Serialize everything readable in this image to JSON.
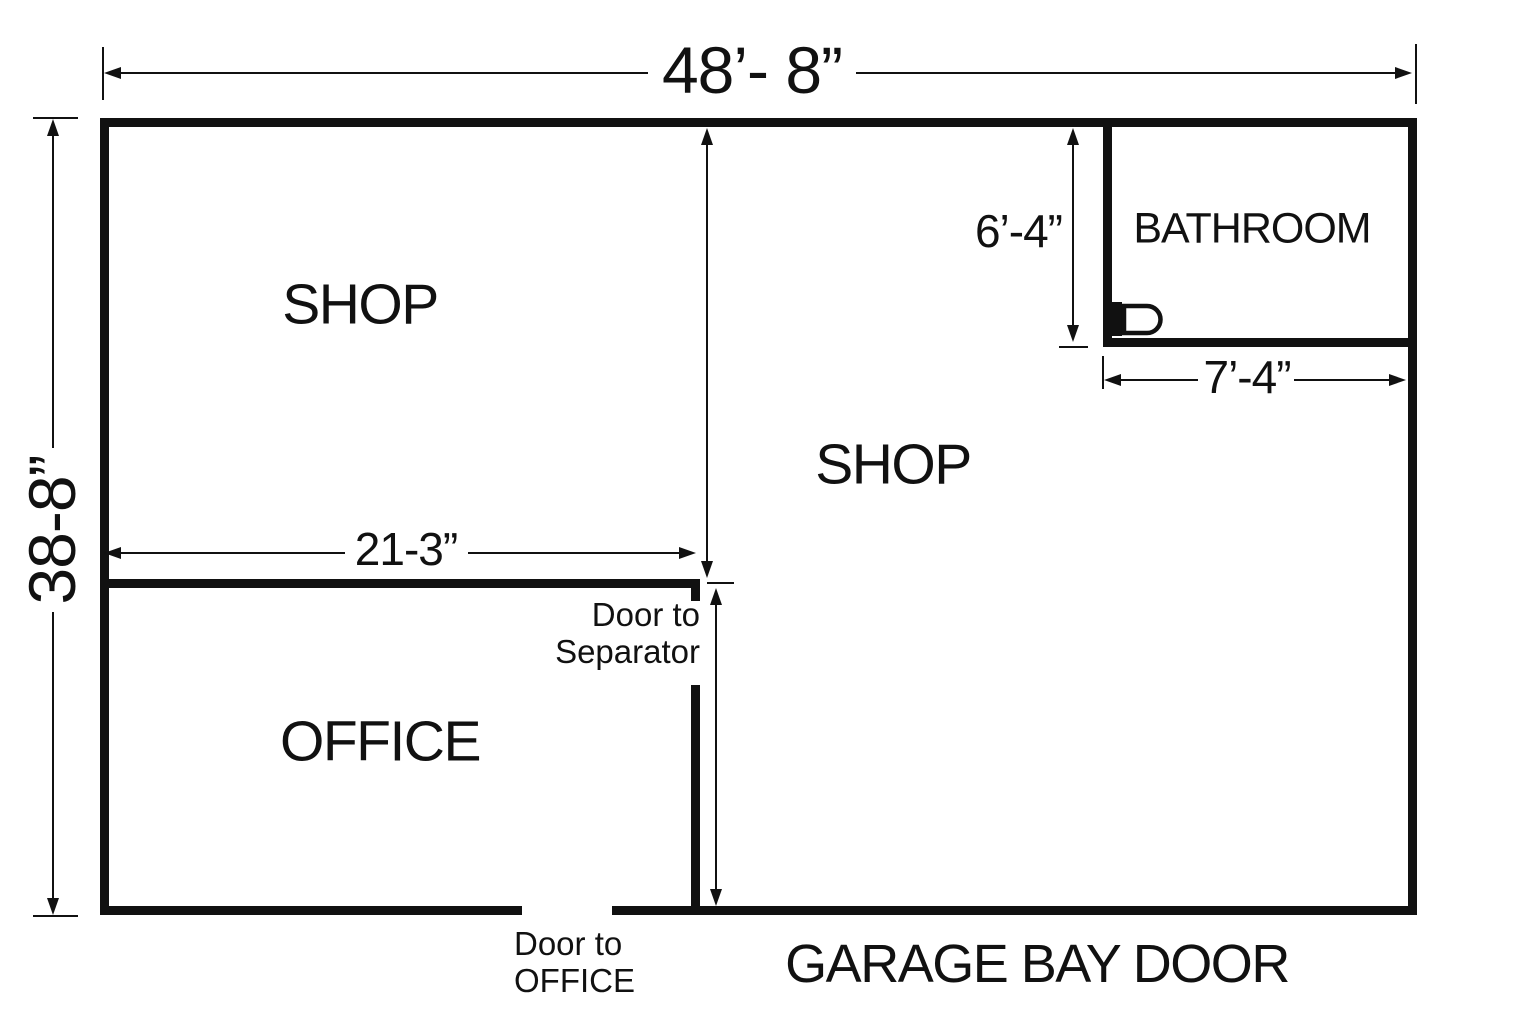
{
  "colors": {
    "ink": "#111111",
    "bg": "#ffffff"
  },
  "dimensions": {
    "overall_width": "48’- 8”",
    "overall_height": "38-8”",
    "partition_width": "21-3”",
    "bathroom_height": "6’-4”",
    "bathroom_width": "7’-4”"
  },
  "rooms": {
    "shop_upper_left": "SHOP",
    "shop_main": "SHOP",
    "office": "OFFICE",
    "bathroom": "BATHROOM"
  },
  "labels": {
    "door_to_separator": {
      "line1": "Door to",
      "line2": "Separator"
    },
    "door_to_office": {
      "line1": "Door to",
      "line2": "OFFICE"
    },
    "garage_bay_door": "GARAGE BAY DOOR"
  },
  "fixtures": {
    "toilet": "toilet-icon"
  }
}
